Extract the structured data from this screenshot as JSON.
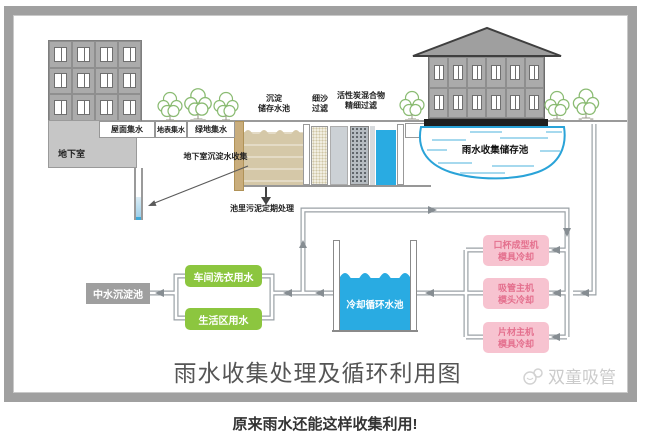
{
  "title": "雨水收集处理及循环利用图",
  "watermark": "双童吸管",
  "caption": "原来雨水还能这样收集利用!",
  "collection": {
    "roof_label": "屋面集水",
    "surface_label": "地表集水",
    "green_label": "绿地集水",
    "basement_label": "地下室",
    "basement_collect_label": "地下室沉淀水收集"
  },
  "treatment": {
    "sediment": {
      "line1": "沉淀",
      "line2": "储存水池"
    },
    "sand": {
      "line1": "细沙",
      "line2": "过滤"
    },
    "carbon": {
      "line1": "活性炭混合物",
      "line2": "精细过滤"
    },
    "sludge_label": "池里污泥定期处理"
  },
  "storage": {
    "pond_label": "雨水收集储存池"
  },
  "reuse": {
    "reclaimed_label": "中水沉淀池",
    "laundry_label": "车间洗衣用水",
    "living_label": "生活区用水",
    "cooling_label": "冷却循环水池",
    "machines": [
      {
        "line1": "口杯成型机",
        "line2": "模具冷却"
      },
      {
        "line1": "吸管主机",
        "line2": "模头冷却"
      },
      {
        "line1": "片材主机",
        "line2": "模具冷却"
      }
    ]
  },
  "colors": {
    "water_blue": "#29abe2",
    "tan_water": "#d5c8a8",
    "green_box": "#8cc63f",
    "pink_box": "#f7c3d0",
    "pink_text": "#e4708e",
    "grey_box": "#9f9f9f",
    "pipe_grey": "#9aa1a6",
    "frame_grey": "#a0a0a0"
  }
}
